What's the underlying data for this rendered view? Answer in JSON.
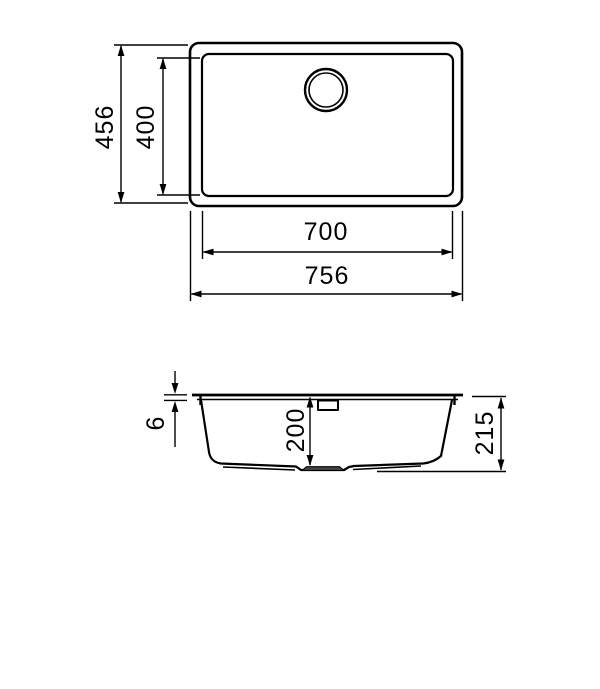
{
  "drawing": {
    "kind": "technical-dimension-drawing",
    "units": "mm",
    "colors": {
      "background": "#ffffff",
      "ink": "#000000",
      "gasket": "#404040"
    },
    "top_view": {
      "overall_depth_label": "456",
      "bowl_depth_label": "400",
      "bowl_width_label": "700",
      "overall_width_label": "756"
    },
    "section_view": {
      "rim_thickness_label": "6",
      "bowl_depth_label": "200",
      "overall_height_label": "215"
    }
  }
}
